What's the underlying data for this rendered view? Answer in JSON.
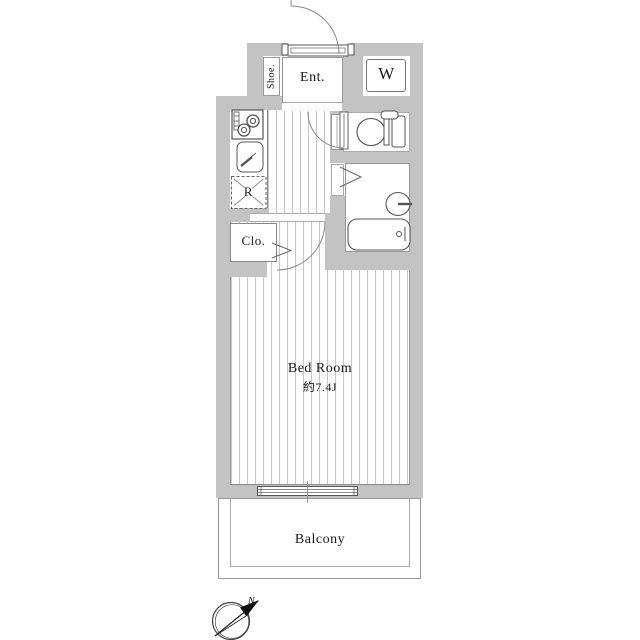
{
  "floorplan": {
    "labels": {
      "shoe": "Shoe.",
      "entrance": "Ent.",
      "washer": "W",
      "fridge": "R",
      "closet": "Clo.",
      "bedroom_name": "Bed Room",
      "bedroom_size": "約7.4J",
      "balcony": "Balcony",
      "north": "N"
    },
    "colors": {
      "wall": "#c3c3c3",
      "floor_stripe": "#c7c7c7",
      "fixture_line": "#555555",
      "text": "#1a1a1a"
    }
  }
}
